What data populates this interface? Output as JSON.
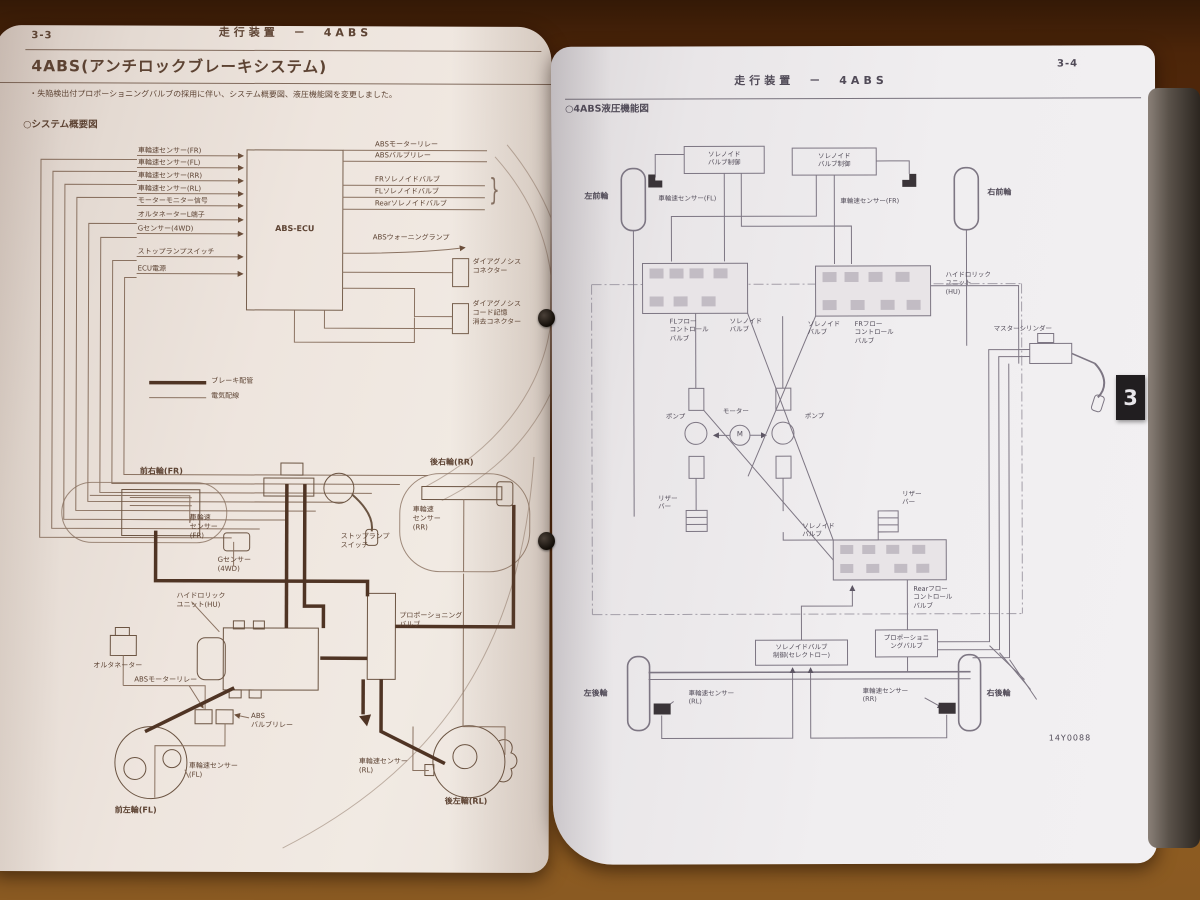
{
  "left_page": {
    "page_no": "3-3",
    "header": "走行装置　－　4ABS",
    "title": "4ABS(アンチロックブレーキシステム)",
    "note": "・失陥検出付プロポーショニングバルブの採用に伴い、システム概要図、液圧機能図を変更しました。",
    "section": "○システム概要図",
    "ecu": "ABS-ECU",
    "brace": "}",
    "inputs": [
      "車輪速センサー(FR)",
      "車輪速センサー(FL)",
      "車輪速センサー(RR)",
      "車輪速センサー(RL)",
      "モーターモニター信号",
      "オルタネーターL端子",
      "Gセンサー(4WD)",
      "ストップランプスイッチ",
      "ECU電源"
    ],
    "outputs": [
      "ABSモーターリレー",
      "ABSバルブリレー",
      "FRソレノイドバルブ",
      "FLソレノイドバルブ",
      "Rearソレノイドバルブ"
    ],
    "warning_lamp": "ABSウォーニングランプ",
    "diag1": "ダイアグノシス\nコネクター",
    "diag2": "ダイアグノシス\nコード記憶\n消去コネクター",
    "legend_brake": "ブレーキ配管",
    "legend_electric": "電気配線",
    "fr_wheel": "前右輪(FR)",
    "rr_wheel": "後右輪(RR)",
    "fl_wheel": "前左輪(FL)",
    "rl_wheel": "後左輪(RL)",
    "sensor_fr": "車輪速\nセンサー\n(FR)",
    "sensor_rr": "車輪速\nセンサー\n(RR)",
    "sensor_fl": "車輪速センサー\n(FL)",
    "sensor_rl": "車輪速センサー\n(RL)",
    "g_sensor": "Gセンサー\n(4WD)",
    "stop_lamp": "ストップランプ\nスイッチ",
    "hu": "ハイドロリック\nユニット(HU)",
    "alternator": "オルタネーター",
    "motor_relay": "ABSモーターリレー",
    "valve_relay": "ABS\nバルブリレー",
    "prop_valve": "プロポーショニング\nバルブ"
  },
  "right_page": {
    "page_no": "3-4",
    "header": "走行装置　－　4ABS",
    "section": "○4ABS液圧機能図",
    "sol_ctrl": "ソレノイド\nバルブ制御",
    "lf_wheel": "左前輪",
    "rf_wheel": "右前輪",
    "lr_wheel": "左後輪",
    "rr_wheel": "右後輪",
    "sensor_fl": "車輪速センサー(FL)",
    "sensor_fr": "車輪速センサー(FR)",
    "sensor_rl": "車輪速センサー\n(RL)",
    "sensor_rr": "車輪速センサー\n(RR)",
    "fl_flow": "FLフロー\nコントロール\nバルブ",
    "fr_flow": "FRフロー\nコントロール\nバルブ",
    "sol_valve": "ソレノイド\nバルブ",
    "hu": "ハイドロリック\nユニット\n(HU)",
    "master": "マスターシリンダー",
    "pump": "ポンプ",
    "motor": "モーター",
    "motor_m": "M",
    "reservoir": "リザー\nバー",
    "rear_flow": "Rearフロー\nコントロール\nバルブ",
    "prop": "プロポーショニ\nングバルブ",
    "sol_ctrl_rear": "ソレノイドバルブ\n制御(セレクトロー)",
    "fig_no": "14Y0088",
    "tab": "3"
  }
}
